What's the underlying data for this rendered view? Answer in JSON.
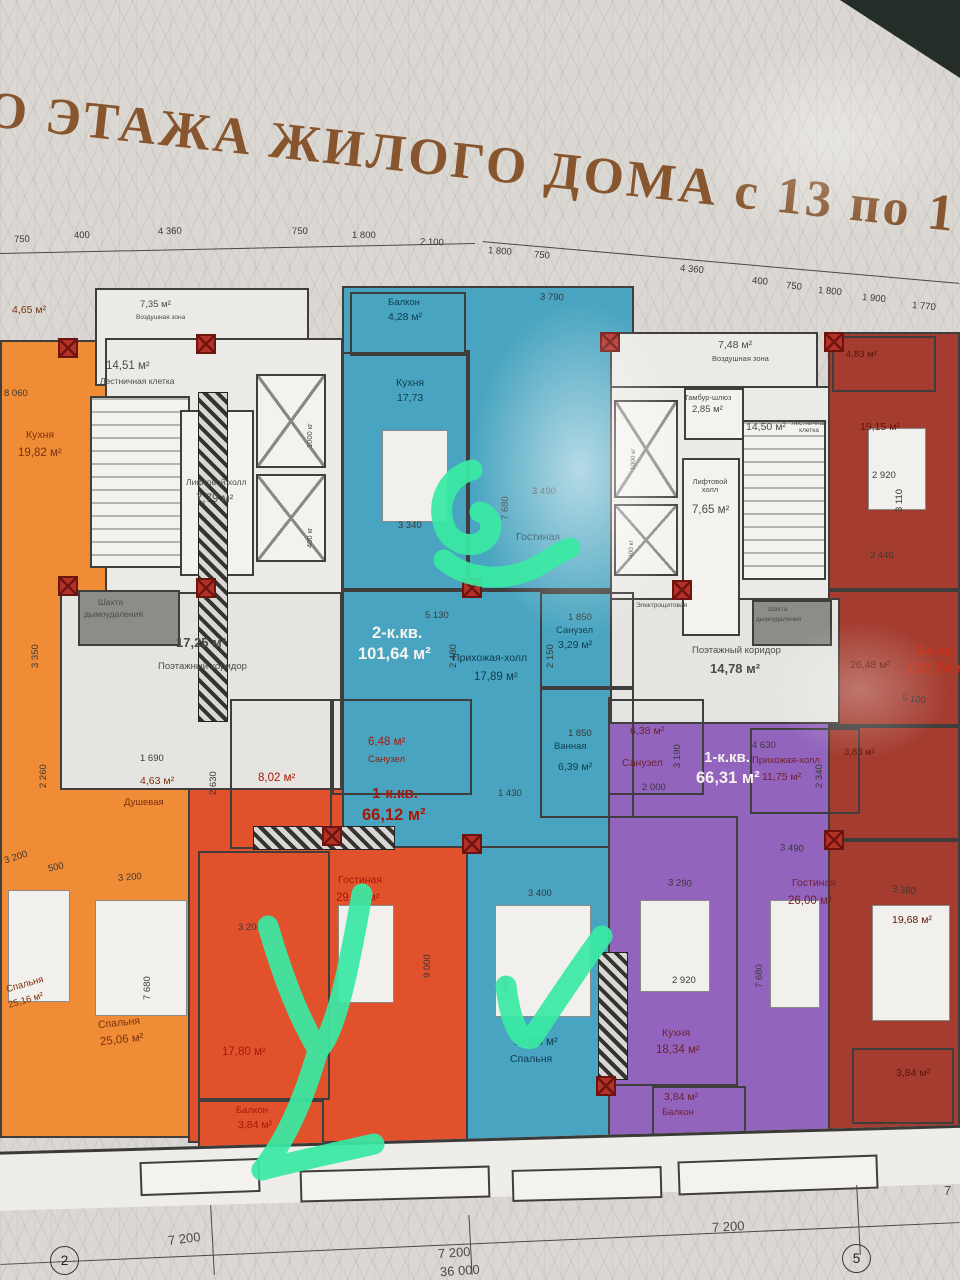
{
  "title": {
    "text": "О ЭТАЖА ЖИЛОГО ДОМА с 13 по 17 ЭТАЖИ"
  },
  "plan": {
    "dims_top": [
      "750",
      "400",
      "4 360",
      "750",
      "1 800",
      "2 100",
      "1 800",
      "750",
      "4 360",
      "400",
      "750",
      "1 800",
      "1 900",
      "1 770"
    ],
    "dims_inner": [
      "3 790",
      "3 490",
      "3 340",
      "7 680",
      "5 130",
      "2 480",
      "2 150",
      "1 850",
      "1 850",
      "1 430",
      "2 630",
      "1 690",
      "2 260",
      "8 060",
      "3 350",
      "3 200",
      "500",
      "3 200",
      "3 200",
      "7 680",
      "9 000",
      "3 400",
      "7 680",
      "3 290",
      "2 920",
      "3 490",
      "7 680",
      "3 380",
      "4 630",
      "2 000",
      "3 190",
      "2 340",
      "5 100",
      "2 920",
      "3 110",
      "3 440"
    ],
    "dims_bottom": [
      "7 200",
      "7 200",
      "36 000",
      "7 200",
      "7"
    ],
    "axes": [
      "2",
      "5"
    ],
    "core_left": {
      "stair_area": "14,51 м²",
      "stair": "Лестничная клетка",
      "lift": "Лифтовой холл",
      "lift_area": "7,79 м²",
      "lift1": "1000 кг",
      "lift2": "400 кг",
      "shaft1": "Шахта",
      "shaft2": "дымоудаления",
      "corr_area": "17,25 м²",
      "corr": "Поэтажный коридор",
      "air_area": "7,35 м²",
      "air": "Воздушная зона"
    },
    "core_right": {
      "air_area": "7,48 м²",
      "air": "Воздушная зона",
      "tambour": "Тамбур-шлюз",
      "tambour_area": "2,85 м²",
      "stair_area": "14,50 м²",
      "stair": "Лестничная клетка",
      "lift": "Лифтовой холл",
      "lift_area": "7,65 м²",
      "lift1": "1000 кг",
      "lift2": "400 кг",
      "corr": "Поэтажный коридор",
      "corr_area": "14,78 м²",
      "shaft1": "Шахта",
      "shaft2": "дымоудаления",
      "electro": "Электрощитовая"
    },
    "apt_orange": {
      "balcony_area": "4,65 м²",
      "kitchen": "Кухня",
      "kitchen_area": "19,82 м²",
      "bedroom1": "Спальня",
      "bedroom1_area": "25,16 м²",
      "bedroom2": "Спальня",
      "bedroom2_area": "25,06 м²",
      "shower": "Душевая",
      "shower_area": "4,63 м²"
    },
    "apt_red": {
      "type": "1-к.кв.",
      "area": "66,12 м²",
      "wc": "Санузел",
      "wc_area": "6,48 м²",
      "hall_area": "8,02 м²",
      "living": "Гостиная",
      "living_area": "29,98 м²",
      "kitchen_area": "17,80 м²",
      "balcony": "Балкон",
      "balcony_area": "3,84 м²"
    },
    "apt_teal": {
      "type": "2-к.кв.",
      "area": "101,64 м²",
      "balcony": "Балкон",
      "balcony_area": "4,28 м²",
      "kitchen": "Кухня",
      "kitchen_area": "17,73",
      "living": "Гостиная",
      "hall": "Прихожая-холл",
      "hall_area": "17,89 м²",
      "wc": "Санузел",
      "wc_area": "3,29 м²",
      "bath": "Ванная",
      "bath_area": "6,39 м²",
      "bedroom": "Спальня",
      "bedroom_area": "17,98 м²"
    },
    "apt_purple": {
      "type": "1-к.кв.",
      "area": "66,31 м²",
      "wc": "Санузел",
      "wc_area": "6,38 м²",
      "hall": "Прихожая-холл",
      "hall_area": "11,75 м²",
      "kitchen": "Кухня",
      "kitchen_area": "18,34 м²",
      "living": "Гостиная",
      "living_area": "26,00 м²",
      "balcony": "Балкон",
      "balcony_area": "3,84 м²"
    },
    "apt_darkred": {
      "type": "3-к.кв.",
      "area": "132,74 м²",
      "balcony_top_area": "4,83 м²",
      "kitchen_area": "19,15 м²",
      "room_area": "26,48 м²",
      "bath_area": "3,83 м²",
      "bedroom_area": "19,68 м²",
      "balcony_bottom_area": "3,84 м²"
    }
  },
  "annotations": {
    "handwritten": [
      "2",
      "У",
      "✓"
    ],
    "marker_color": "#3ae9a4"
  }
}
